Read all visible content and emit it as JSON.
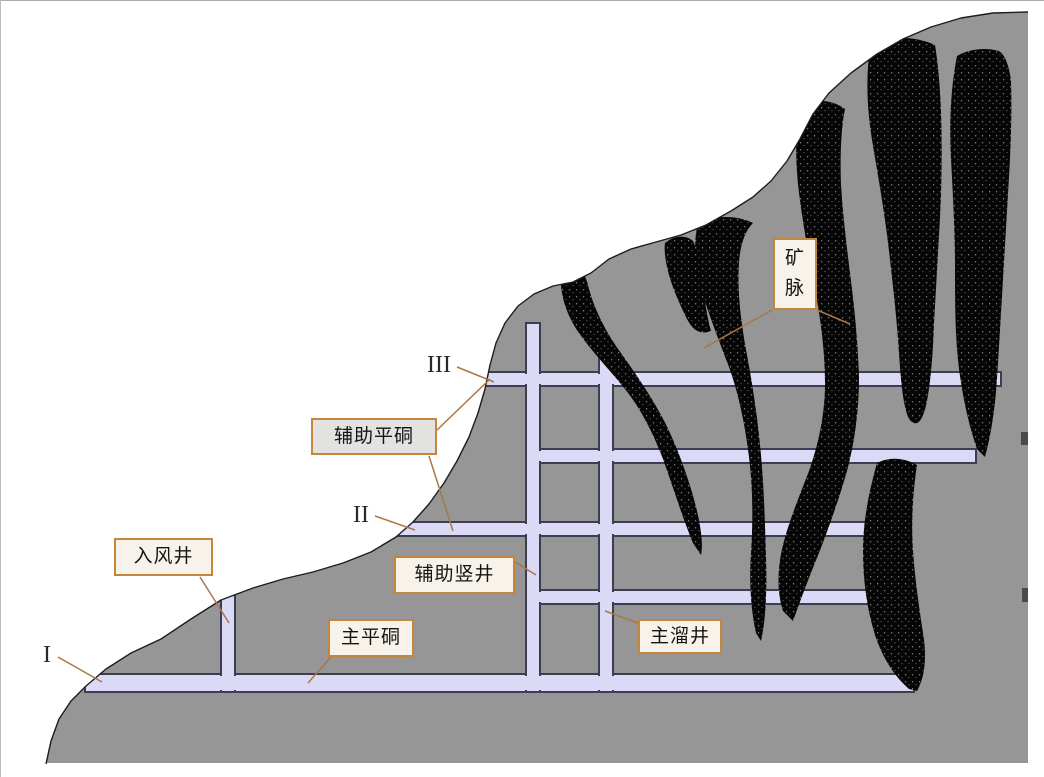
{
  "diagram": {
    "type": "mining-cross-section",
    "labels": {
      "ore_vein": "矿脉",
      "auxiliary_adit": "辅助平硐",
      "air_intake_shaft": "入风井",
      "auxiliary_shaft": "辅助竖井",
      "main_adit": "主平硐",
      "main_ore_pass": "主溜井"
    },
    "level_markers": {
      "level_3": "III",
      "level_2": "II",
      "level_1": "I"
    },
    "colors": {
      "background": "#ffffff",
      "mountain_fill": "#969696",
      "mountain_outline": "#1d1d1d",
      "tunnel_fill": "#dadaf6",
      "tunnel_border": "#3d3d52",
      "ore_vein_fill": "#060606",
      "callout_border": "#c5853c",
      "callout_fill": "#f7f3ea",
      "callout_fill_alt": "#e2e2e0",
      "leader_line": "#a87848"
    }
  }
}
